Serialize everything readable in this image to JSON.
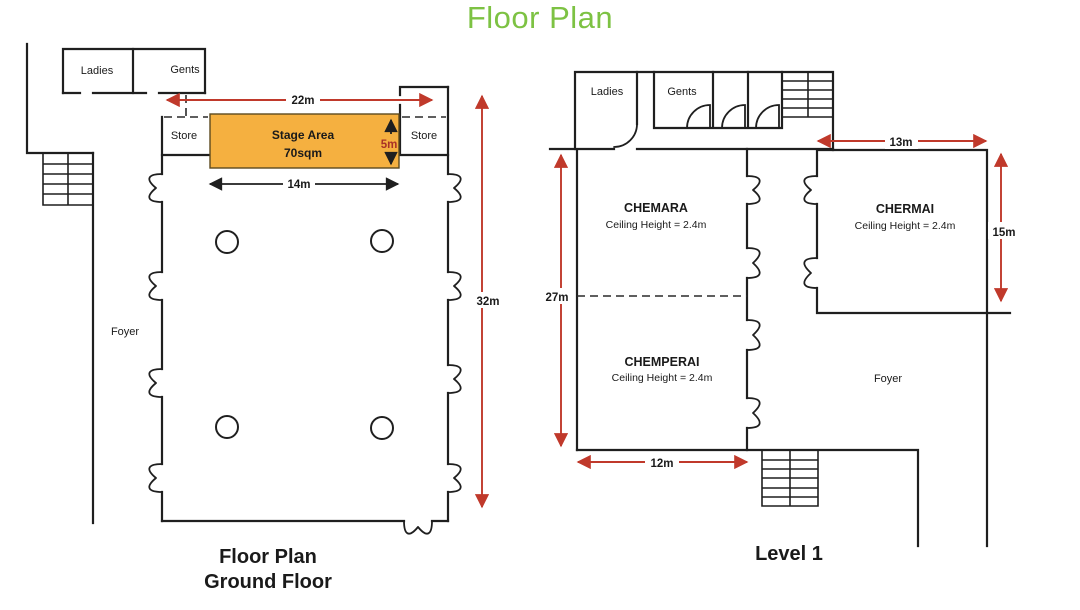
{
  "title": "Floor Plan",
  "colors": {
    "title_green": "#7dc243",
    "wall_black": "#1f1f1f",
    "dimension_red": "#c0392b",
    "stage_depth_red": "#a93226",
    "stage_orange": "#f5b040"
  },
  "ground_floor": {
    "caption": [
      "Floor Plan",
      "Ground Floor"
    ],
    "rooms": {
      "ladies": "Ladies",
      "gents": "Gents",
      "store_left": "Store",
      "store_right": "Store",
      "foyer": "Foyer"
    },
    "stage": {
      "name": "Stage Area",
      "area": "70sqm"
    },
    "dimensions": {
      "top_width": "22m",
      "stage_width": "14m",
      "stage_depth": "5m",
      "hall_length": "32m"
    }
  },
  "level1": {
    "caption": "Level 1",
    "rooms": {
      "ladies": "Ladies",
      "gents": "Gents",
      "foyer": "Foyer",
      "chemara": {
        "name": "CHEMARA",
        "ceiling": "Ceiling Height = 2.4m"
      },
      "chemperai": {
        "name": "CHEMPERAI",
        "ceiling": "Ceiling Height = 2.4m"
      },
      "chermai": {
        "name": "CHERMAI",
        "ceiling": "Ceiling Height = 2.4m"
      }
    },
    "dimensions": {
      "chermai_width": "13m",
      "chermai_depth": "15m",
      "hall_length": "27m",
      "chemperai_width": "12m"
    }
  }
}
